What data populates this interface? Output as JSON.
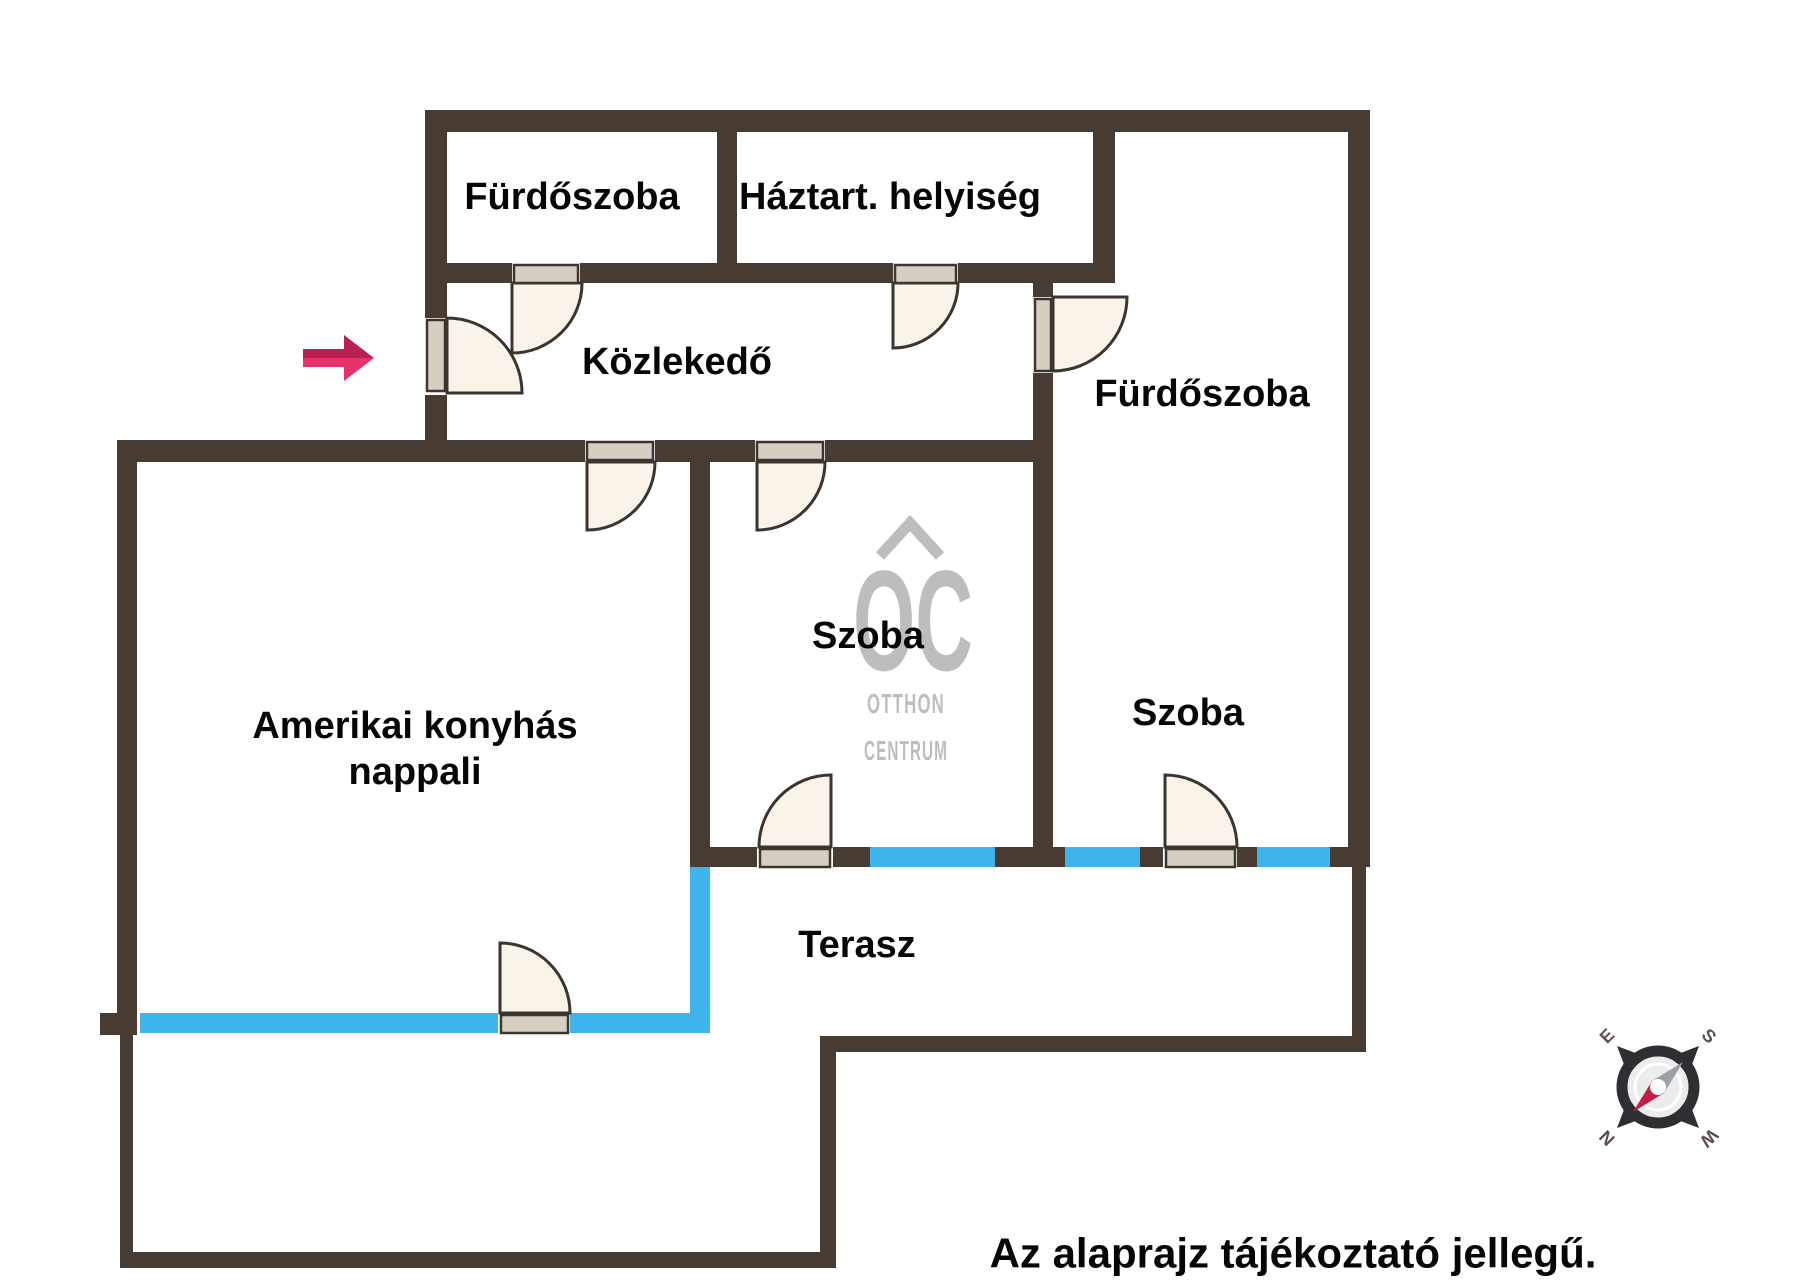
{
  "floorplan": {
    "rooms": [
      {
        "id": "bathroom-top",
        "label": "Fürdőszoba"
      },
      {
        "id": "utility-room",
        "label": "Háztart. helyiség"
      },
      {
        "id": "hallway",
        "label": "Közlekedő"
      },
      {
        "id": "bathroom-right",
        "label": "Fürdőszoba"
      },
      {
        "id": "room-middle",
        "label": "Szoba"
      },
      {
        "id": "room-right",
        "label": "Szoba"
      },
      {
        "id": "living-room",
        "label_line1": "Amerikai konyhás",
        "label_line2": "nappali"
      },
      {
        "id": "terrace",
        "label": "Terasz"
      }
    ],
    "disclaimer": "Az alaprajz tájékoztató jellegű.",
    "watermark": {
      "initials": "OC",
      "line1": "OTTHON",
      "line2": "CENTRUM"
    },
    "compass": {
      "north": "N",
      "east": "E",
      "south": "S",
      "west": "W"
    },
    "colors": {
      "wall": "#473b32",
      "window": "#3fb3ec",
      "door_fill": "#faf3ea",
      "door_leaf": "#d6cec1",
      "door_stroke": "#3a352f",
      "arrow_top": "#bb2150",
      "arrow_bottom": "#e8336a",
      "watermark": "#bdbdbd",
      "compass_dark": "#2e2f33",
      "compass_inner": "#ececec",
      "compass_letter": "#5f4f4d",
      "needle_red": "#c61c4a",
      "needle_gray": "#9aa0a6"
    }
  }
}
